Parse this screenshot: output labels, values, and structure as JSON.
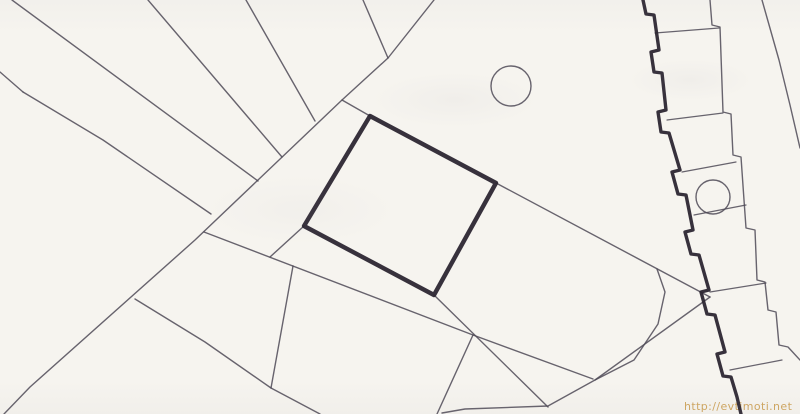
{
  "page": {
    "kind": "scanned cadastral site plan",
    "paper_color": "#f6f4ef"
  },
  "watermark": {
    "text": "http://evtimoti.net",
    "color": "#c7943e",
    "x": 684,
    "y": 410
  },
  "drawing": {
    "stroke_thin": "#4e4956",
    "stroke_bold": "#2c2631",
    "thin_width": 1.4,
    "bold_plot_width": 4.4,
    "thin_lines": [
      {
        "name": "left-edge-stub",
        "points": [
          [
            0,
            72
          ],
          [
            23,
            92
          ]
        ]
      },
      {
        "name": "fan-line-left",
        "points": [
          [
            23,
            92
          ],
          [
            103,
            140
          ],
          [
            211,
            214
          ]
        ]
      },
      {
        "name": "fan-line-1",
        "points": [
          [
            12,
            0
          ],
          [
            258,
            181
          ]
        ]
      },
      {
        "name": "fan-line-2",
        "points": [
          [
            148,
            0
          ],
          [
            282,
            157
          ]
        ]
      },
      {
        "name": "fan-line-3",
        "points": [
          [
            246,
            0
          ],
          [
            315,
            121
          ]
        ]
      },
      {
        "name": "fan-line-4",
        "points": [
          [
            363,
            0
          ],
          [
            388,
            58
          ]
        ]
      },
      {
        "name": "road-boundary",
        "points": [
          [
            434,
            0
          ],
          [
            388,
            58
          ],
          [
            342,
            100
          ],
          [
            195,
            240
          ],
          [
            30,
            387
          ],
          [
            4,
            414
          ]
        ]
      },
      {
        "name": "road-to-plot-connector",
        "points": [
          [
            342,
            100
          ],
          [
            370,
            116
          ]
        ]
      },
      {
        "name": "strip-upper-boundary",
        "points": [
          [
            496,
            183
          ],
          [
            710,
            297
          ]
        ]
      },
      {
        "name": "curved-parcel-boundary",
        "points": [
          [
            657,
            269
          ],
          [
            665,
            292
          ],
          [
            658,
            324
          ],
          [
            634,
            360
          ],
          [
            595,
            380
          ]
        ]
      },
      {
        "name": "diagonal-parcel-boundary",
        "points": [
          [
            710,
            297
          ],
          [
            595,
            380
          ],
          [
            548,
            406
          ],
          [
            465,
            409
          ],
          [
            442,
            413
          ]
        ]
      },
      {
        "name": "lower-strip-boundary",
        "points": [
          [
            204,
            232
          ],
          [
            473,
            335
          ],
          [
            593,
            379
          ]
        ]
      },
      {
        "name": "plot-corner-stub",
        "points": [
          [
            304,
            226
          ],
          [
            270,
            257
          ]
        ]
      },
      {
        "name": "cross-parcel-line",
        "points": [
          [
            293,
            266
          ],
          [
            271,
            388
          ]
        ]
      },
      {
        "name": "lower-left-parcel-line",
        "points": [
          [
            135,
            299
          ],
          [
            205,
            342
          ],
          [
            271,
            388
          ],
          [
            320,
            414
          ]
        ]
      },
      {
        "name": "plot-extension-line",
        "points": [
          [
            434,
            295
          ],
          [
            548,
            407
          ]
        ]
      },
      {
        "name": "short-drop-line",
        "points": [
          [
            473,
            335
          ],
          [
            437,
            414
          ]
        ]
      },
      {
        "name": "outer-right-boundary",
        "points": [
          [
            762,
            0
          ],
          [
            779,
            60
          ],
          [
            790,
            105
          ],
          [
            800,
            148
          ]
        ]
      },
      {
        "name": "building-right-edge",
        "points": [
          [
            710,
            0
          ],
          [
            712,
            25
          ],
          [
            720,
            27
          ],
          [
            723,
            112
          ],
          [
            731,
            114
          ],
          [
            733,
            155
          ],
          [
            741,
            157
          ],
          [
            744,
            200
          ],
          [
            746,
            228
          ],
          [
            755,
            230
          ],
          [
            757,
            280
          ],
          [
            765,
            282
          ],
          [
            768,
            310
          ],
          [
            776,
            312
          ],
          [
            779,
            345
          ],
          [
            788,
            347
          ],
          [
            800,
            360
          ]
        ]
      },
      {
        "name": "building-partition-1",
        "points": [
          [
            655,
            33
          ],
          [
            719,
            28
          ]
        ],
        "w": 1.2
      },
      {
        "name": "building-partition-2",
        "points": [
          [
            667,
            120
          ],
          [
            723,
            113
          ]
        ],
        "w": 1.2
      },
      {
        "name": "building-partition-3",
        "points": [
          [
            682,
            172
          ],
          [
            736,
            162
          ]
        ],
        "w": 1.2
      },
      {
        "name": "building-partition-4",
        "points": [
          [
            694,
            215
          ],
          [
            746,
            205
          ]
        ],
        "w": 1.2
      },
      {
        "name": "building-partition-5",
        "points": [
          [
            710,
            292
          ],
          [
            766,
            283
          ]
        ],
        "w": 1.2
      },
      {
        "name": "building-partition-6",
        "points": [
          [
            730,
            370
          ],
          [
            782,
            360
          ]
        ],
        "w": 1.2
      }
    ],
    "bold_lines": [
      {
        "name": "building-left-edge",
        "w": 3.4,
        "points": [
          [
            643,
            0
          ],
          [
            646,
            14
          ],
          [
            654,
            15
          ],
          [
            659,
            50
          ],
          [
            651,
            52
          ],
          [
            654,
            72
          ],
          [
            662,
            73
          ],
          [
            666,
            110
          ],
          [
            658,
            112
          ],
          [
            661,
            132
          ],
          [
            669,
            133
          ],
          [
            680,
            170
          ],
          [
            672,
            172
          ],
          [
            678,
            194
          ],
          [
            686,
            195
          ],
          [
            693,
            230
          ],
          [
            685,
            232
          ],
          [
            691,
            254
          ],
          [
            699,
            255
          ],
          [
            709,
            290
          ],
          [
            701,
            292
          ],
          [
            707,
            314
          ],
          [
            715,
            315
          ],
          [
            725,
            352
          ],
          [
            717,
            354
          ],
          [
            723,
            376
          ],
          [
            731,
            377
          ],
          [
            737,
            397
          ],
          [
            741,
            414
          ]
        ]
      }
    ],
    "bold_polygons": [
      {
        "name": "highlighted-plot-outline",
        "points": [
          [
            370,
            116
          ],
          [
            496,
            183
          ],
          [
            434,
            295
          ],
          [
            304,
            226
          ]
        ]
      }
    ],
    "circles": [
      {
        "name": "tree-circle-top",
        "cx": 511,
        "cy": 86,
        "r": 20
      },
      {
        "name": "tree-circle-building",
        "cx": 713,
        "cy": 197,
        "r": 17
      }
    ]
  }
}
